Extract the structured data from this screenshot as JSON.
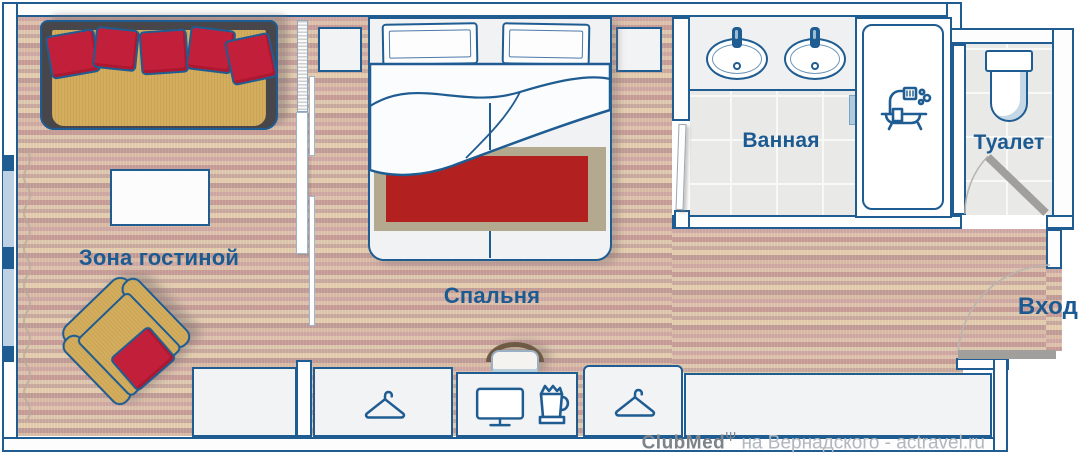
{
  "canvas": {
    "width": 1080,
    "height": 455
  },
  "labels": {
    "living": "Зона гостиной",
    "bedroom": "Спальня",
    "bathroom": "Ванная",
    "toilet": "Туалет",
    "entrance": "Вход"
  },
  "watermark": {
    "brand": "ClubMed",
    "trident": "Ψ",
    "text": "на Вернадского - actravel.ru"
  },
  "icons": {
    "wardrobe": "hanger-icon",
    "desk": "monitor-icon",
    "kettle": "kettle-icon",
    "shower": "bathtub-shower-icon",
    "wc": "toilet-icon",
    "sinks": "sink-icon"
  },
  "colors": {
    "accent_blue": "#1e5c92",
    "carpet_rose": "#cda6a1",
    "carpet_tan": "#dcc5ad",
    "sofa_yellow": "#d4ae5e",
    "pillow_red": "#c2203a",
    "runner_red": "#b32020",
    "runner_band": "#b3a98f",
    "door_gray": "#a09f9b",
    "tile_gray": "#e9eae8",
    "window_blue": "#bcd2e4",
    "watermark_dark": "#7d838a",
    "watermark_light": "#b0b7bd"
  }
}
